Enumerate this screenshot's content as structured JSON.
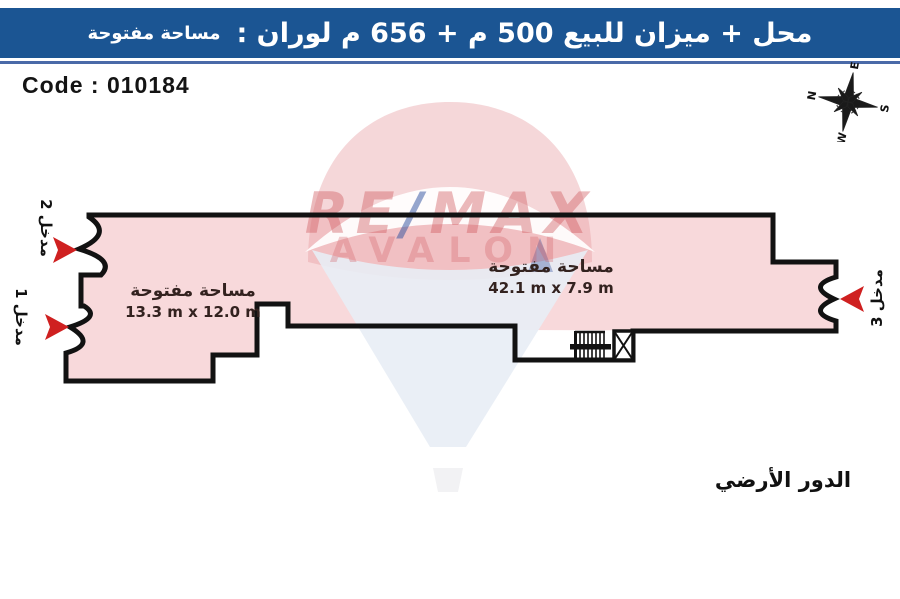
{
  "banner": {
    "title_main": "محل + ميزان للبيع 500 م + 656 م لوران :",
    "title_suffix": "مساحة مفتوحة",
    "bg_color": "#1b5593",
    "text_color": "#ffffff"
  },
  "header": {
    "code_label": "Code : 010184"
  },
  "compass": {
    "n": "N",
    "e": "E",
    "s": "S",
    "w": "W"
  },
  "watermark": {
    "brand_left": "RE",
    "brand_slash": "/",
    "brand_right": "MAX",
    "brand_sub": "AVALON",
    "brand_red": "#d05a60",
    "brand_blue": "#2b4d9e"
  },
  "plan": {
    "fill_color": "#f8d9db",
    "outline_color": "#121212",
    "arrow_color": "#cf2020",
    "rooms": [
      {
        "label": "مساحة مفتوحة",
        "dimensions": "13.3 m x 12.0 m"
      },
      {
        "label": "مساحة مفتوحة",
        "dimensions": "42.1 m x 7.9 m"
      }
    ],
    "entrances": [
      {
        "label": "مدخل 2"
      },
      {
        "label": "مدخل 1"
      },
      {
        "label": "مدخل 3"
      }
    ],
    "floor_label": "الدور الأرضي"
  }
}
